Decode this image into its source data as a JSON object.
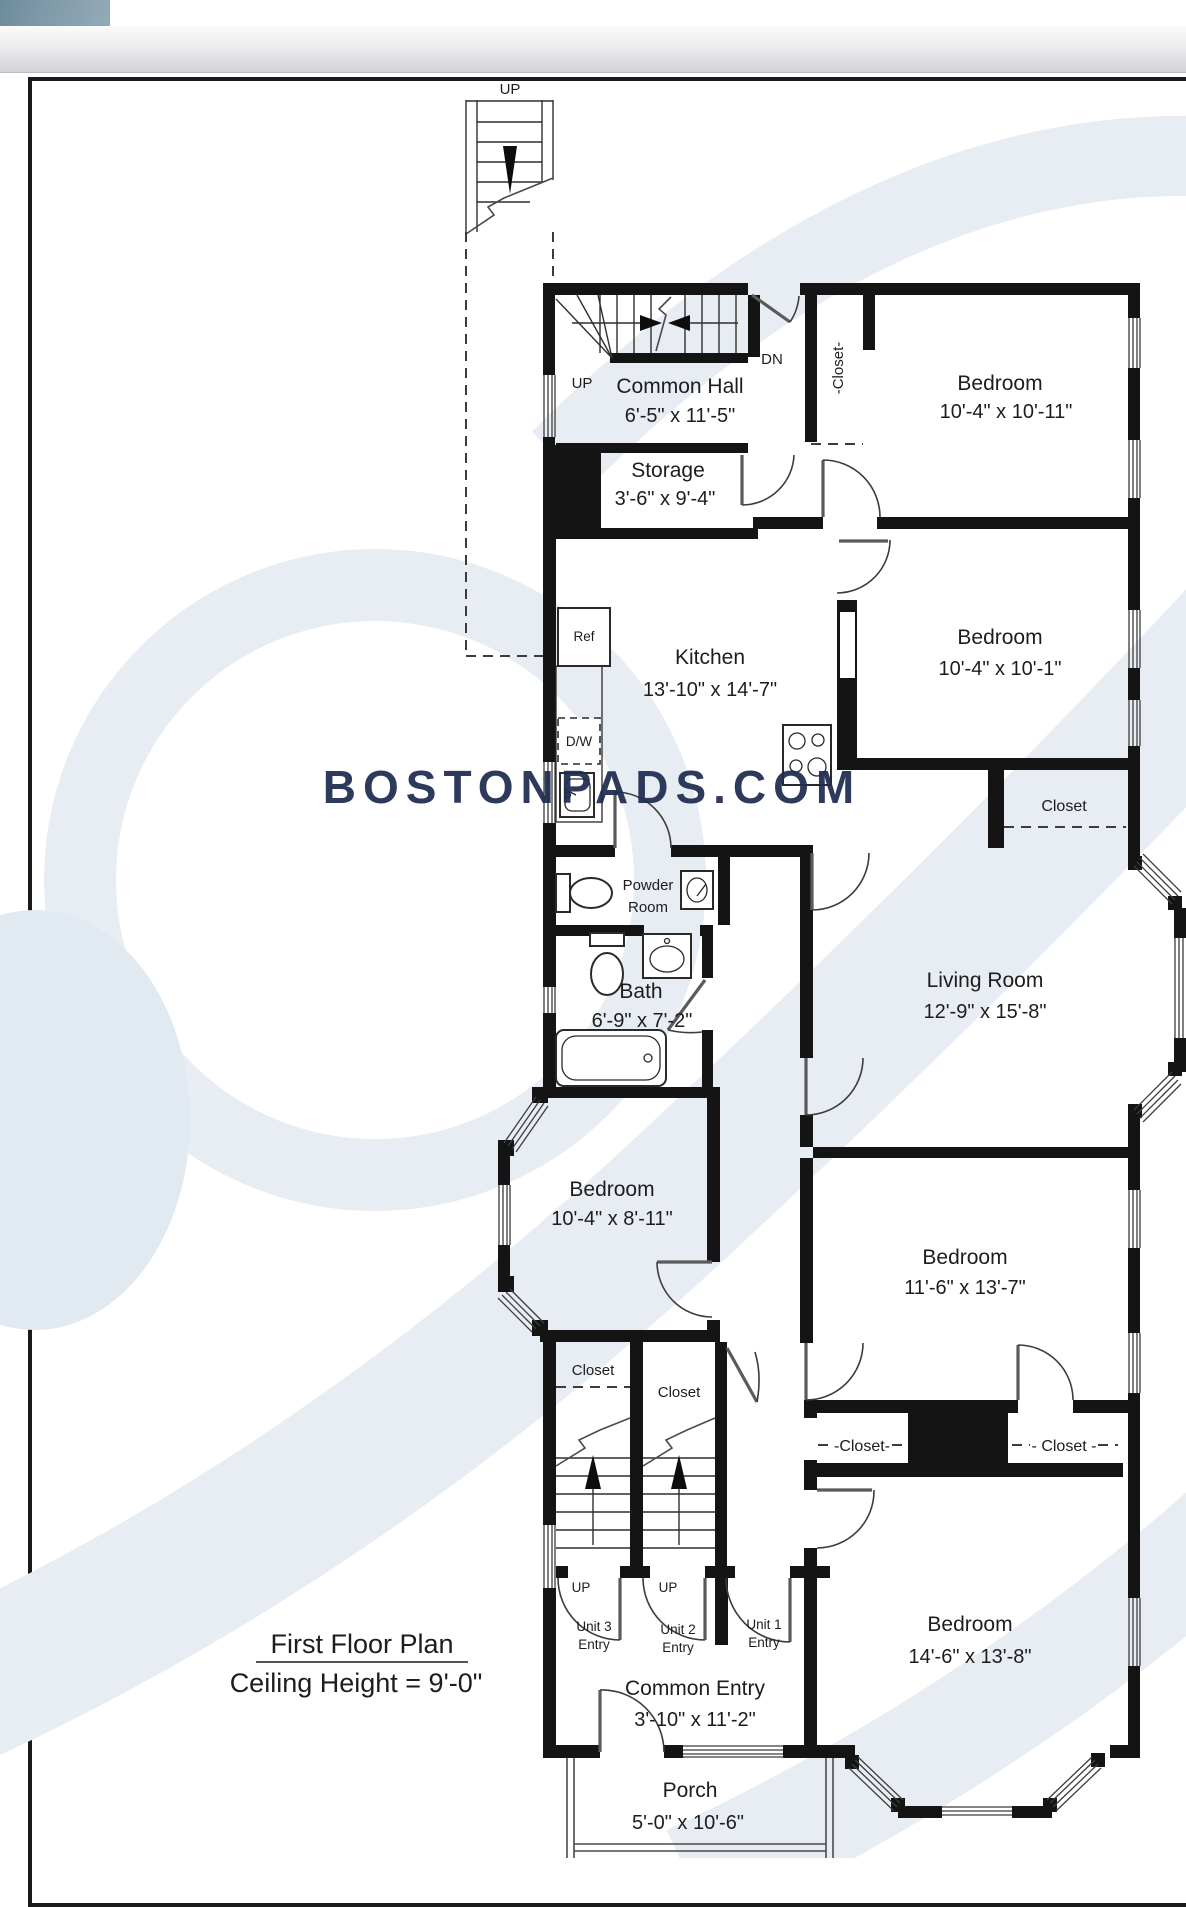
{
  "colors": {
    "wall": "#141414",
    "line": "#3c3c3c",
    "watermark": "#1e2c4f",
    "swirl": "#e7edf3",
    "swirl_solid": "#e2eaf1",
    "tab_dark": "#6d8b9b",
    "tab_light": "#93abb9"
  },
  "plan": {
    "title": "First Floor Plan",
    "subtitle": "Ceiling Height = 9'-0\"",
    "watermark": "BOSTONPADS.COM",
    "stairs": {
      "up_top": "UP",
      "hall_up": "UP",
      "hall_dn": "DN",
      "stair_left_up": "UP",
      "stair_right_up": "UP"
    },
    "fixtures": {
      "refrigerator": "Ref",
      "dishwasher": "D/W"
    },
    "rooms": {
      "common_hall": {
        "name": "Common Hall",
        "dims": "6'-5\" x 11'-5\""
      },
      "storage": {
        "name": "Storage",
        "dims": "3'-6\" x 9'-4\""
      },
      "bedroom_top": {
        "name": "Bedroom",
        "dims": "10'-4\" x 10'-11\""
      },
      "kitchen": {
        "name": "Kitchen",
        "dims": "13'-10\" x 14'-7\""
      },
      "bedroom_upper": {
        "name": "Bedroom",
        "dims": "10'-4\" x 10'-1\""
      },
      "powder_room": {
        "line1": "Powder",
        "line2": "Room"
      },
      "bath": {
        "name": "Bath",
        "dims": "6'-9\" x 7'-2\""
      },
      "living_room": {
        "name": "Living Room",
        "dims": "12'-9\" x 15'-8\""
      },
      "bedroom_middle_left": {
        "name": "Bedroom",
        "dims": "10'-4\" x 8'-11\""
      },
      "bedroom_middle_right": {
        "name": "Bedroom",
        "dims": "11'-6\" x 13'-7\""
      },
      "bedroom_bottom": {
        "name": "Bedroom",
        "dims": "14'-6\" x 13'-8\""
      },
      "common_entry": {
        "name": "Common Entry",
        "dims": "3'-10\" x 11'-2\""
      },
      "porch": {
        "name": "Porch",
        "dims": "5'-0\" x 10'-6\""
      }
    },
    "closets": {
      "top_rotated": "-Closet-",
      "bedroom2": "Closet",
      "mid_left": "Closet",
      "mid_right": "Closet",
      "lower_left": "-Closet-",
      "lower_right": "- Closet -"
    },
    "entries": {
      "unit3": {
        "line1": "Unit 3",
        "line2": "Entry"
      },
      "unit2": {
        "line1": "Unit 2",
        "line2": "Entry"
      },
      "unit1": {
        "line1": "Unit 1",
        "line2": "Entry"
      }
    }
  }
}
